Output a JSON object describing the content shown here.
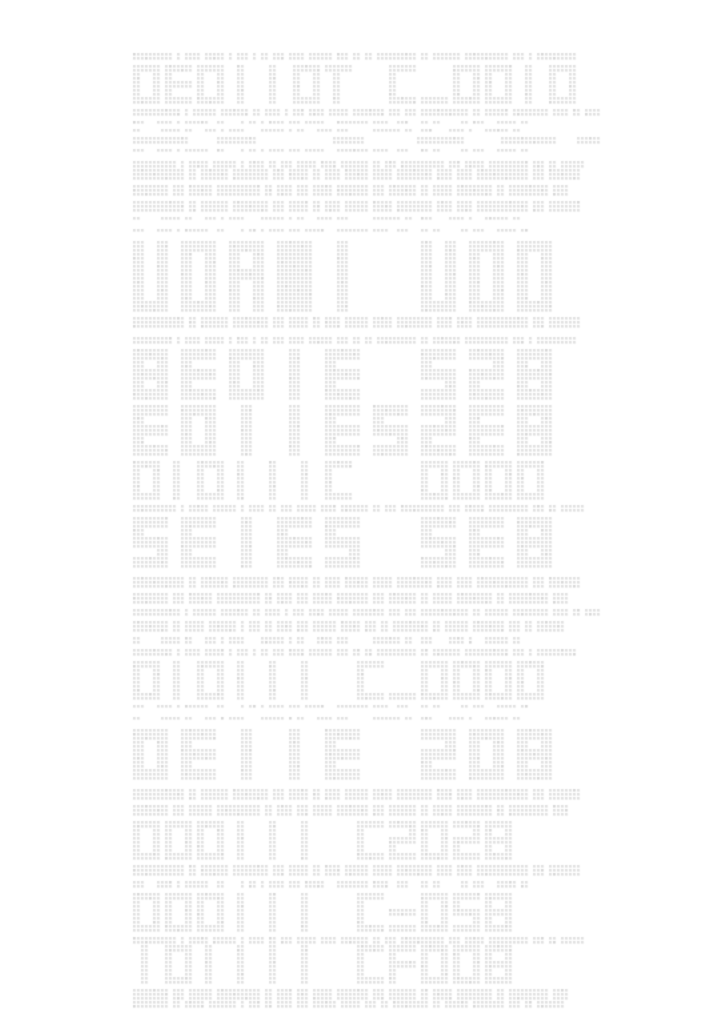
{
  "meta": {
    "description": "Page of light-gray dot-matrix placeholder text: large hollow LED-segment letterform headings alternating with rows of small greeked dotted text on a white background",
    "background_color": "#ffffff"
  },
  "grid": {
    "origin_x": 133,
    "origin_y": 53,
    "pitch": 4,
    "dot": 2.6,
    "cols": 117,
    "color": "#e1e1e1",
    "color_alt": "#d8d8d8"
  },
  "words": {
    "W1": [
      10,
      1,
      4,
      5,
      1,
      3,
      1,
      2,
      3,
      4,
      6,
      3,
      2,
      2,
      10,
      2,
      7,
      11,
      3,
      1,
      10
    ],
    "W2": [
      12,
      1,
      6,
      7,
      2,
      4,
      1,
      3,
      4,
      5,
      8,
      3,
      3,
      12,
      2,
      6,
      9,
      4,
      2,
      5
    ],
    "W3": [
      3,
      -2,
      4,
      1,
      6,
      -1,
      2,
      -3,
      1,
      2,
      1,
      4,
      3,
      5,
      -2,
      8,
      4,
      -1,
      3,
      -2,
      2,
      2,
      -4,
      2,
      3,
      -2,
      5,
      2
    ],
    "W3b": [
      2,
      -4,
      5,
      2,
      -2,
      3,
      1,
      4,
      -3,
      6,
      1,
      2,
      -2,
      4,
      3,
      -5,
      7,
      2,
      -1,
      3,
      -3,
      4,
      1,
      -2,
      6,
      2
    ],
    "W4": [
      11,
      1,
      5,
      6,
      1,
      4,
      2,
      3,
      5,
      4,
      7,
      2,
      3,
      11,
      3,
      5,
      10,
      3,
      2,
      6
    ],
    "W5": [
      13,
      2,
      7,
      9,
      3,
      5,
      2,
      4,
      6,
      5,
      9,
      4,
      4,
      13,
      3,
      8
    ],
    "W5b": [
      9,
      3,
      6,
      11,
      2,
      4,
      3,
      5,
      8,
      3,
      7,
      2,
      5,
      9,
      2,
      10,
      4
    ],
    "W6": [
      9,
      2,
      5,
      7,
      1,
      3,
      2,
      4,
      3,
      6,
      5,
      3,
      2,
      9,
      2,
      6,
      8,
      3,
      2,
      7
    ],
    "BARS": [
      14,
      -6,
      10,
      -18,
      8,
      -12,
      12,
      -8,
      14,
      -4,
      6
    ]
  },
  "lines": [
    {
      "r": 0,
      "t": "g",
      "h": 2,
      "w": "W1"
    },
    {
      "r": 3,
      "t": "h1",
      "s": "DEOIIOT C_ODID"
    },
    {
      "r": 14,
      "t": "g",
      "h": 2,
      "w": "W2"
    },
    {
      "r": 17,
      "t": "g",
      "h": 1,
      "w": "W3"
    },
    {
      "r": 19,
      "t": "g",
      "h": 1,
      "w": "W3b"
    },
    {
      "r": 21,
      "t": "g",
      "h": 2,
      "w": "BARS"
    },
    {
      "r": 24,
      "t": "g",
      "h": 1,
      "w": "W3"
    },
    {
      "r": 27,
      "t": "g",
      "h": 2,
      "w": "W4"
    },
    {
      "r": 29,
      "t": "g",
      "h": 3,
      "w": "W5"
    },
    {
      "r": 33,
      "t": "g",
      "h": 3,
      "w": "W5b"
    },
    {
      "r": 37,
      "t": "g",
      "h": 3,
      "w": "W5"
    },
    {
      "r": 41,
      "t": "g",
      "h": 1,
      "w": "W3b"
    },
    {
      "r": 44,
      "t": "g",
      "h": 1,
      "w": "W3"
    },
    {
      "r": 47,
      "t": "h3",
      "s": "UOAWI UOD"
    },
    {
      "r": 66,
      "t": "g",
      "h": 3,
      "w": "W5"
    },
    {
      "r": 71,
      "t": "g",
      "h": 2,
      "w": "W1"
    },
    {
      "r": 74,
      "t": "h2",
      "s": "8EOIE SZ8"
    },
    {
      "r": 88,
      "t": "h2",
      "s": "EOIIESZE8"
    },
    {
      "r": 102,
      "t": "h1",
      "s": "DIOIIIC  ODOD"
    },
    {
      "r": 113,
      "t": "g",
      "h": 2,
      "w": "W4"
    },
    {
      "r": 116,
      "t": "h2",
      "s": "SEIES SE8"
    },
    {
      "r": 131,
      "t": "g",
      "h": 3,
      "w": "W5"
    },
    {
      "r": 135,
      "t": "g",
      "h": 3,
      "w": "W5b"
    },
    {
      "r": 139,
      "t": "g",
      "h": 2,
      "w": "W2"
    },
    {
      "r": 142,
      "t": "g",
      "h": 3,
      "w": "W6"
    },
    {
      "r": 146,
      "t": "g",
      "h": 2,
      "w": "W3b"
    },
    {
      "r": 149,
      "t": "g",
      "h": 2,
      "w": "W1"
    },
    {
      "r": 152,
      "t": "h1",
      "s": "DIOIII C_ODOD"
    },
    {
      "r": 163,
      "t": "g",
      "h": 1,
      "w": "W3"
    },
    {
      "r": 166,
      "t": "g",
      "h": 1,
      "w": "W3b"
    },
    {
      "r": 169,
      "t": "h2",
      "s": "OEIIE ZO8"
    },
    {
      "r": 184,
      "t": "g",
      "h": 3,
      "w": "W5"
    },
    {
      "r": 188,
      "t": "g",
      "h": 3,
      "w": "W5b"
    },
    {
      "r": 192,
      "t": "h1",
      "s": "DODIII CZOZ8"
    },
    {
      "r": 203,
      "t": "g",
      "h": 3,
      "w": "W5"
    },
    {
      "r": 207,
      "t": "g",
      "h": 2,
      "w": "W3"
    },
    {
      "r": 210,
      "t": "h1",
      "s": "DOOIII C=OS8"
    },
    {
      "r": 221,
      "t": "g",
      "h": 2,
      "w": "W4"
    },
    {
      "r": 223,
      "t": "h1",
      "s": "IOIIII CFOO8"
    },
    {
      "r": 234,
      "t": "g",
      "h": 3,
      "w": "W5b"
    },
    {
      "r": 237,
      "t": "g",
      "h": 2,
      "w": "W6"
    }
  ]
}
